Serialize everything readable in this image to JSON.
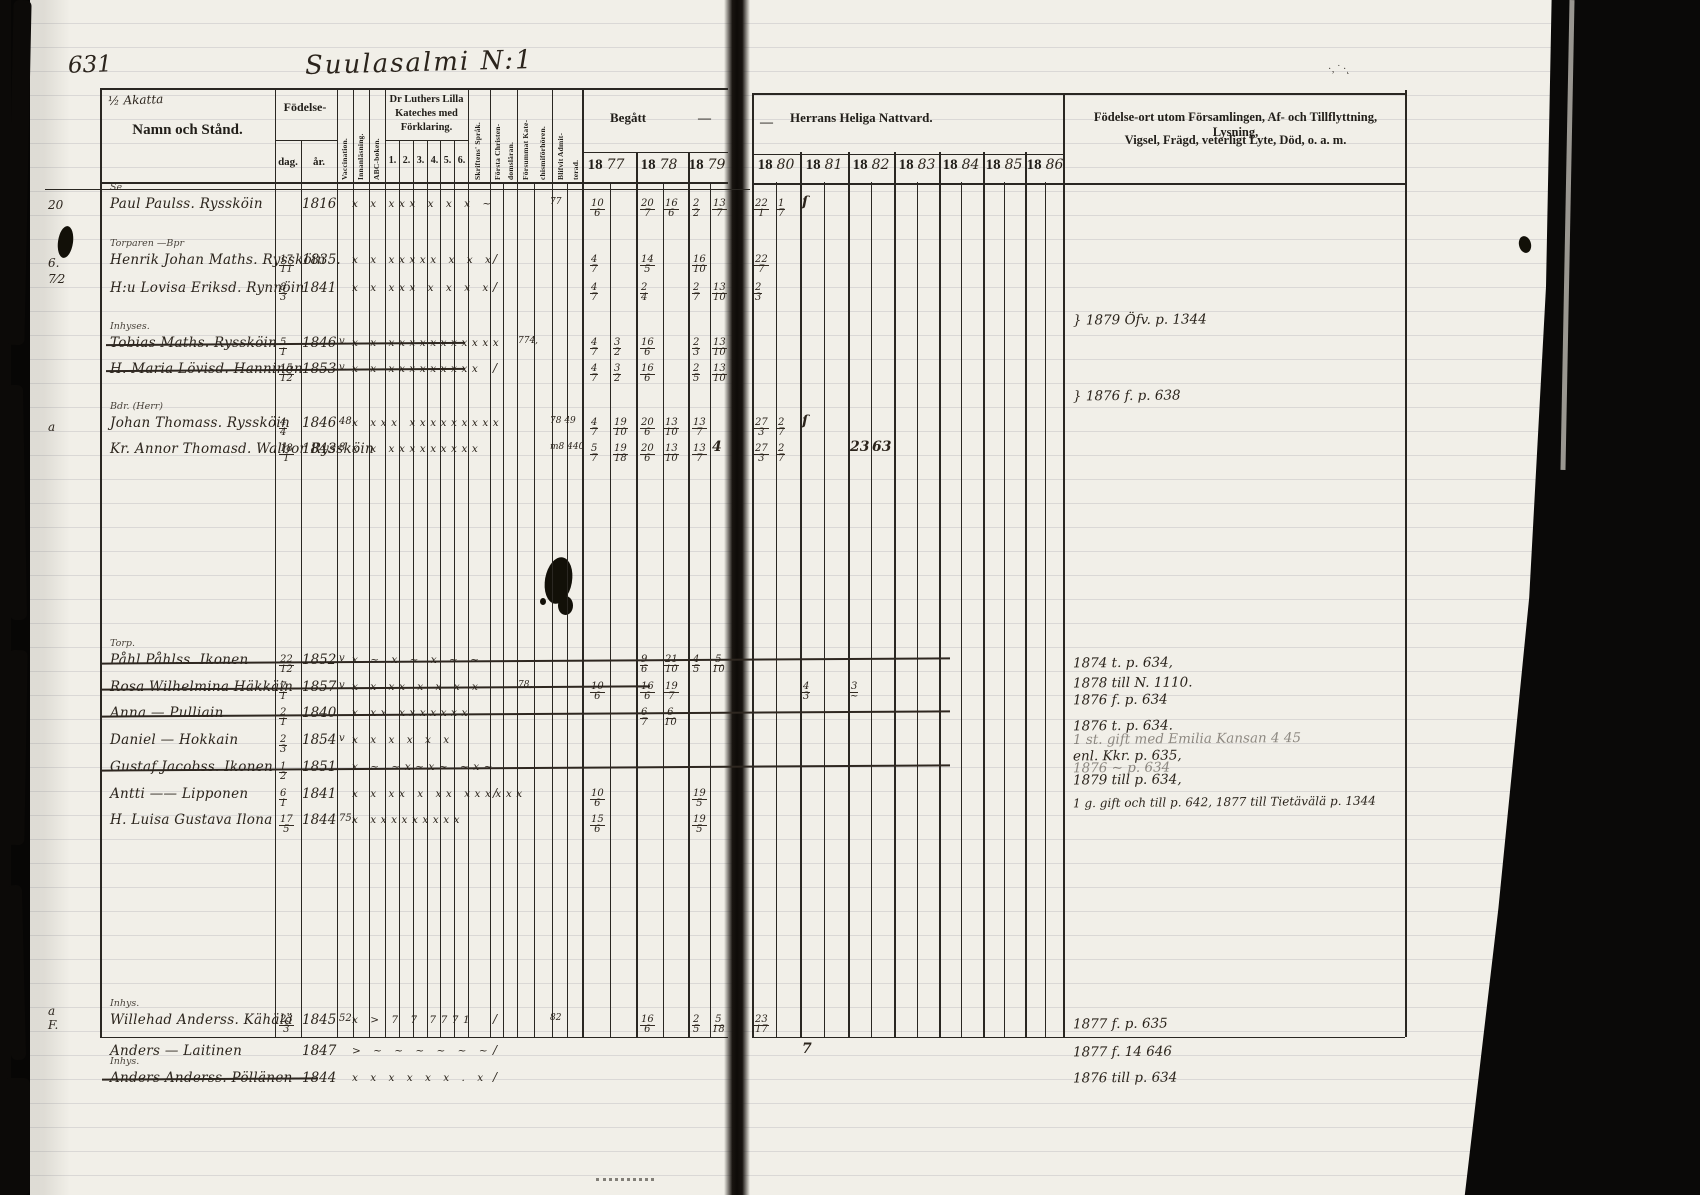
{
  "document": {
    "page_number": "631",
    "title": "Suulasalmi N:1",
    "margin_top_note": "½ Akatta"
  },
  "table_header": {
    "name_col": "Namn och Stånd.",
    "birth": "Födelse-",
    "birth_day": "dag.",
    "birth_year": "år.",
    "vaccination": "Vaccination.",
    "reading": "Innanläsning.",
    "abc": "ABC-boken.",
    "kateches_l1": "Dr Luthers Lilla",
    "kateches_l2": "Kateches med",
    "kateches_l3": "Förklaring.",
    "kateches_nums": [
      "1.",
      "2.",
      "3.",
      "4.",
      "5.",
      "6."
    ],
    "script_col": "Skriftens' Språk.",
    "first_chr_l1": "Första Christen-",
    "first_chr_l2": "domsläran.",
    "missed_l1": "Försummat Kate-",
    "missed_l2": "chismiförhören.",
    "admitted_l1": "Blifvit Admit-",
    "admitted_l2": "terad.",
    "begatt": "Begått",
    "dash1": "—",
    "dash2": "—",
    "nattvard": "Herrans Heliga Nattvard.",
    "year_prefix": "18",
    "year_suffixes": [
      "77",
      "78",
      "79",
      "80",
      "81",
      "82",
      "83",
      "84",
      "85",
      "86"
    ],
    "notes_l1": "Födelse-ort utom Församlingen, Af- och Tillflyttning, Lysning,",
    "notes_l2": "Vigsel, Frägd, veterligt Lyte, Död, o. a. m."
  },
  "rows": [
    {
      "above": "Se",
      "name": "Paul Paulss. Ryssköin",
      "struck": false,
      "day": "",
      "year": "1816",
      "pre": "",
      "marks": "x x xxx x x x ~",
      "fsm": "",
      "adm": "77",
      "fc": "",
      "com": {
        "1877": "10/6",
        "1878": "20/7|16/6",
        "1879": "2/2|13/7",
        "1880": "22/1|1/7",
        "1881": "ſ"
      }
    },
    {
      "above": "Torparen —Bpr",
      "name": "Henrik Johan Maths. Ryssköin",
      "struck": false,
      "day": "17/11",
      "year": "1835.",
      "pre": "",
      "marks": "x x xxxxx x x x",
      "fsm": "",
      "adm": "",
      "fc": "/",
      "com": {
        "1877": "4/7",
        "1878": "14/5",
        "1879": "16/10",
        "1880": "22/7"
      }
    },
    {
      "above": "",
      "name": "H:u Lovisa Eriksd. Rynnöin",
      "struck": false,
      "day": "8/3",
      "year": "1841",
      "pre": "",
      "marks": "x x xxx x x x x",
      "fsm": "",
      "adm": "",
      "fc": "/",
      "com": {
        "1877": "4/7",
        "1878": "2/4",
        "1879": "2/7|13/10",
        "1880": "2/3"
      }
    },
    {
      "above": "Inhyses.",
      "name": "Tobias Maths. Ryssköin",
      "struck": true,
      "day": "5/1",
      "year": "1846",
      "pre": "v.",
      "marks": "x x xxxxxxxxxxx",
      "fsm": "774,",
      "adm": "",
      "fc": "",
      "com": {
        "1877": "4/7|3/2",
        "1878": "16/6",
        "1879": "2/3|13/10"
      }
    },
    {
      "above": "",
      "name": "H. Maria Lövisd. Hanninen",
      "struck": true,
      "day": "15/12",
      "year": "1853",
      "pre": "v.",
      "marks": "x x xxxxxxxxx",
      "fsm": "",
      "adm": "",
      "fc": "/",
      "com": {
        "1877": "4/7|3/2",
        "1878": "16/6",
        "1879": "2/5|13/10"
      }
    },
    {
      "above": "Bdr. (Herr)",
      "name": "Johan Thomass. Ryssköin",
      "struck": false,
      "day": "4/4",
      "year": "1846",
      "pre": "48",
      "marks": "x xxx xxxxxxxxx",
      "fsm": "",
      "adm": "78 49",
      "fc": "",
      "com": {
        "1877": "4/7|19/10",
        "1878": "20/6|13/10",
        "1879": "13/7",
        "1880": "27/3|2/7",
        "1881": "ſ"
      }
    },
    {
      "above": "",
      "name": "Kr. Annor Thomasd. Walbor Ryssköin",
      "struck": false,
      "day": "18/1",
      "year": "1843",
      "pre": "8",
      "marks": "x x xxxxxxxxx",
      "fsm": "",
      "adm": "m8 440",
      "fc": "",
      "com": {
        "1877": "5/7|19/18",
        "1878": "20/6|13/10",
        "1879": "13/7|4",
        "1880": "27/3|2/7",
        "1882": "23|63"
      }
    },
    {
      "above": "Torp.",
      "name": "Påhl Påhlss. Ikonen",
      "struck": true,
      "day": "22/12",
      "year": "1852",
      "pre": "v",
      "marks": "x ~ x ~ x ~ ~",
      "fsm": "",
      "adm": "",
      "fc": "",
      "com": {
        "1878": "9/6|21/10",
        "1879": "4/5|5/10"
      }
    },
    {
      "above": "",
      "name": "Rosa Wilhelmina Häkkäin",
      "struck": true,
      "day": "7/1",
      "year": "1857",
      "pre": "v",
      "marks": "x x xx x x x x",
      "fsm": "78,",
      "adm": "",
      "fc": "",
      "com": {
        "1877": "10/6",
        "1878": "16/6|19/7",
        "1881": "4/3",
        "1882": "3/~"
      }
    },
    {
      "above": "",
      "name": "Anna — Pulliain",
      "struck": true,
      "day": "2/1",
      "year": "1840",
      "pre": "",
      "marks": "x xx xxxxxxx",
      "fsm": "",
      "adm": "",
      "fc": "",
      "com": {
        "1878": "6/7|6/10"
      }
    },
    {
      "above": "",
      "name": "Daniel — Hokkain",
      "struck": false,
      "day": "2/3",
      "year": "1854",
      "pre": "v",
      "marks": "x x x x x x",
      "fsm": "",
      "adm": "",
      "fc": "",
      "com": {}
    },
    {
      "above": "",
      "name": "Gustaf Jacobss. Ikonen",
      "struck": true,
      "day": "1/2",
      "year": "1851",
      "pre": "",
      "marks": "x ~ ~x~x~ ~x~",
      "fsm": "",
      "adm": "",
      "fc": "",
      "com": {}
    },
    {
      "above": "",
      "name": "Antti —— Lipponen",
      "struck": false,
      "day": "6/1",
      "year": "1841",
      "pre": "",
      "marks": "x x xx x xx xxxxxx",
      "fsm": "",
      "adm": "",
      "fc": "/",
      "com": {
        "1877": "10/6",
        "1879": "19/5"
      }
    },
    {
      "above": "",
      "name": "H. Luisa Gustava Ilona",
      "struck": false,
      "day": "17/5",
      "year": "1844",
      "pre": "75,",
      "marks": "x xxxxxxxxx",
      "fsm": "",
      "adm": "",
      "fc": "",
      "com": {
        "1877": "15/6",
        "1879": "19/5"
      }
    },
    {
      "above": "Inhys.",
      "name": "Willehad Anderss. Kähälä",
      "struck": false,
      "day": "23/3",
      "year": "1845",
      "pre": "52",
      "marks": "x > 7 7 7771",
      "fsm": "",
      "adm": "82",
      "fc": "/",
      "com": {
        "1878": "16/6",
        "1879": "2/5|5/18",
        "1880": "23/17"
      }
    },
    {
      "above": "",
      "name": "Anders — Laitinen",
      "struck": false,
      "day": "",
      "year": "1847",
      "pre": "",
      "marks": "> ~ ~ ~ ~ ~ ~",
      "fsm": "",
      "adm": "",
      "fc": "/",
      "com": {
        "1881": "7"
      }
    },
    {
      "above": "Inhys.",
      "name": "Anders Anderss. Pöllänen",
      "struck": true,
      "day": "",
      "year": "1844",
      "pre": "",
      "marks": "x x x x x x . x",
      "fsm": "",
      "adm": "",
      "fc": "/",
      "com": {}
    }
  ],
  "notes": [
    "} 1879 Öfv. p. 1344",
    "} 1876 f. p. 638",
    "1874 t. p. 634,",
    "1878 till N. 1110.",
    "1876 f. p. 634",
    "1876 t. p. 634.",
    "1 st. gift med Emilia Kansan 4 45",
    "enl. Kkr. p. 635,",
    "1876 ~ p. 634",
    "1879 till p. 634,",
    "1 g. gift och till p. 642, 1877 till Tietävälä p. 1344",
    "1877 f. p. 635",
    "1877 f. 14 646",
    "1876 till p. 634"
  ],
  "margin_notes": [
    "20",
    "6.",
    "7⁄2",
    "a",
    "a",
    "F."
  ]
}
